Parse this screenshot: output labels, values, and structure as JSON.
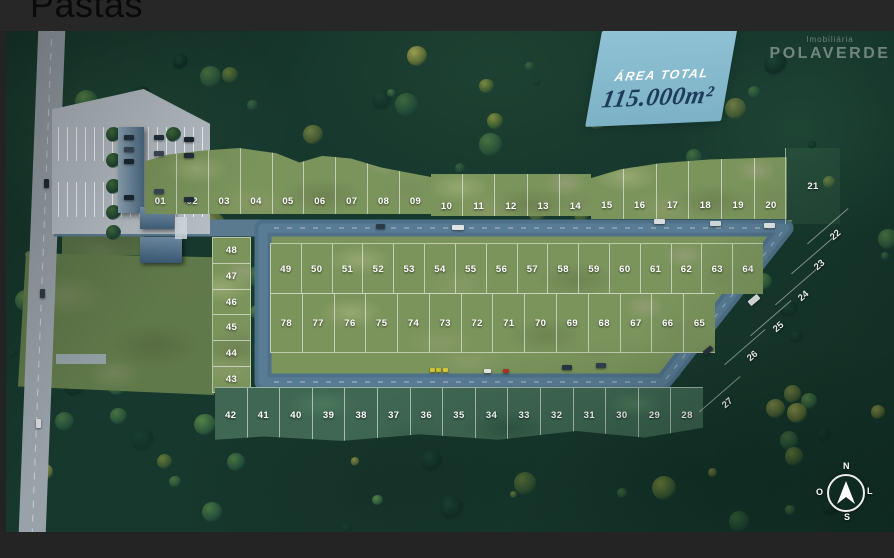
{
  "window": {
    "title": "Pastas"
  },
  "badge": {
    "label": "ÁREA TOTAL",
    "value": "115.000m²"
  },
  "watermark": {
    "line1": "Imobiliária",
    "line2": "POLAVERDE"
  },
  "compass": {
    "north": "N",
    "south": "S",
    "west": "O",
    "east": "L"
  },
  "lots": {
    "top_row_a": [
      "01",
      "02",
      "03",
      "04",
      "05",
      "06",
      "07",
      "08",
      "09"
    ],
    "top_row_b": [
      "10",
      "11",
      "12",
      "13",
      "14"
    ],
    "top_row_c": [
      "15",
      "16",
      "17",
      "18",
      "19",
      "20"
    ],
    "lot_21": [
      "21"
    ],
    "right_column": [
      "22",
      "23",
      "24",
      "25",
      "26",
      "27"
    ],
    "left_column": [
      "48",
      "47",
      "46",
      "45",
      "44",
      "43"
    ],
    "middle_row_1": [
      "49",
      "50",
      "51",
      "52",
      "53",
      "54",
      "55",
      "56",
      "57",
      "58",
      "59",
      "60",
      "61",
      "62",
      "63",
      "64"
    ],
    "middle_row_2": [
      "78",
      "77",
      "76",
      "75",
      "74",
      "73",
      "72",
      "71",
      "70",
      "69",
      "68",
      "67",
      "66",
      "65"
    ],
    "bottom_row": [
      "42",
      "41",
      "40",
      "39",
      "38",
      "37",
      "36",
      "35",
      "34",
      "33",
      "32",
      "31",
      "30",
      "29",
      "28"
    ]
  },
  "colors": {
    "badge-bg": "#8fc2d4",
    "badge-text": "#1d3c5a",
    "road": "#4e7189",
    "highway": "#99a2a9",
    "forest": "#17382d",
    "grass": "#7b945c"
  }
}
